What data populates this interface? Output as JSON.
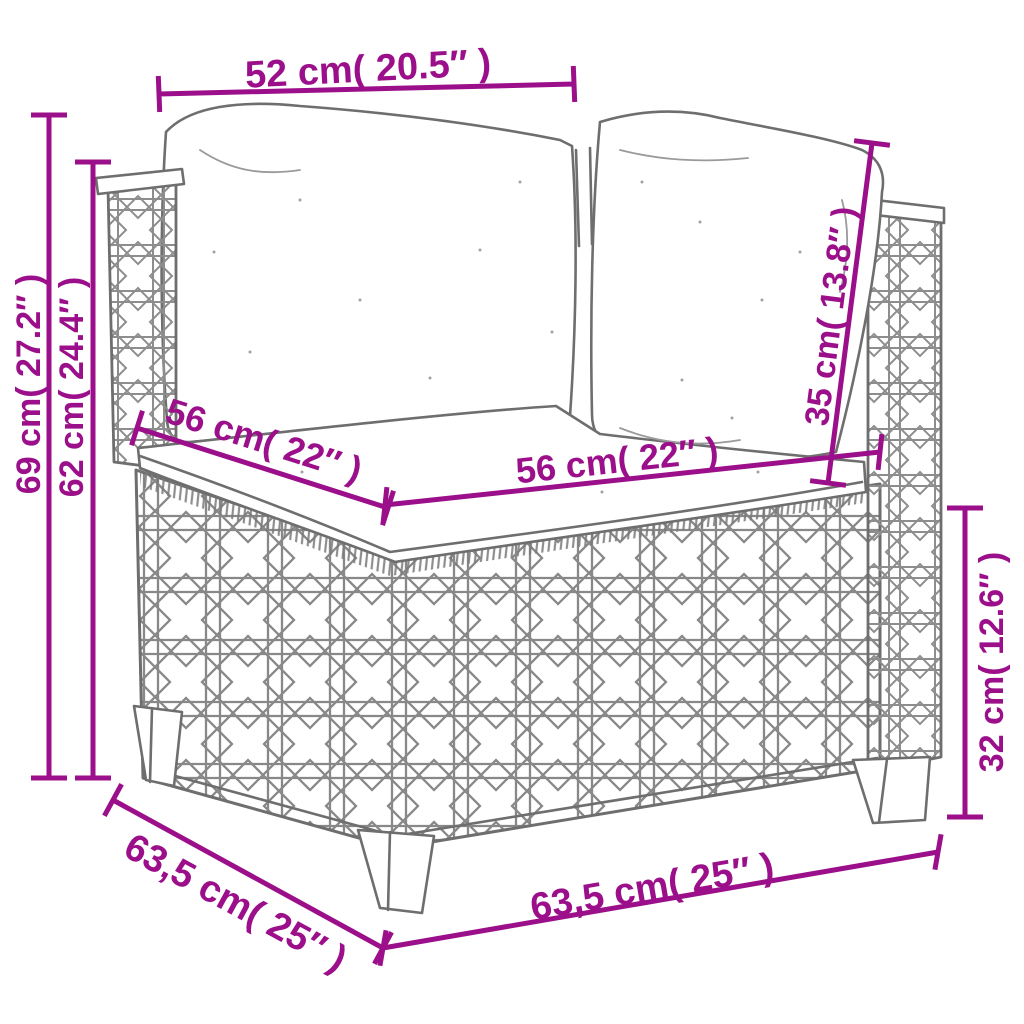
{
  "style": {
    "accent_color": "#9c0f8a",
    "drawing_color": "#6e6e6e",
    "background_color": "#ffffff"
  },
  "dimensions": {
    "back_width": {
      "label": "52 cm( 20.5″ )",
      "value_cm": "52",
      "value_in": "20.5"
    },
    "total_height": {
      "label": "69 cm( 27.2″ )",
      "value_cm": "69",
      "value_in": "27.2"
    },
    "side_height": {
      "label": "62 cm( 24.4″ )",
      "value_cm": "62",
      "value_in": "24.4"
    },
    "seat_depth": {
      "label": "56 cm( 22″ )",
      "value_cm": "56",
      "value_in": "22"
    },
    "seat_width": {
      "label": "56 cm( 22″ )",
      "value_cm": "56",
      "value_in": "22"
    },
    "back_cushion_height": {
      "label": "35 cm( 13.8″ )",
      "value_cm": "35",
      "value_in": "13.8"
    },
    "base_height": {
      "label": "32 cm( 12.6″ )",
      "value_cm": "32",
      "value_in": "12.6"
    },
    "total_depth": {
      "label": "63,5 cm( 25″ )",
      "value_cm": "63,5",
      "value_in": "25"
    },
    "total_width": {
      "label": "63,5 cm( 25″ )",
      "value_cm": "63,5",
      "value_in": "25"
    }
  }
}
